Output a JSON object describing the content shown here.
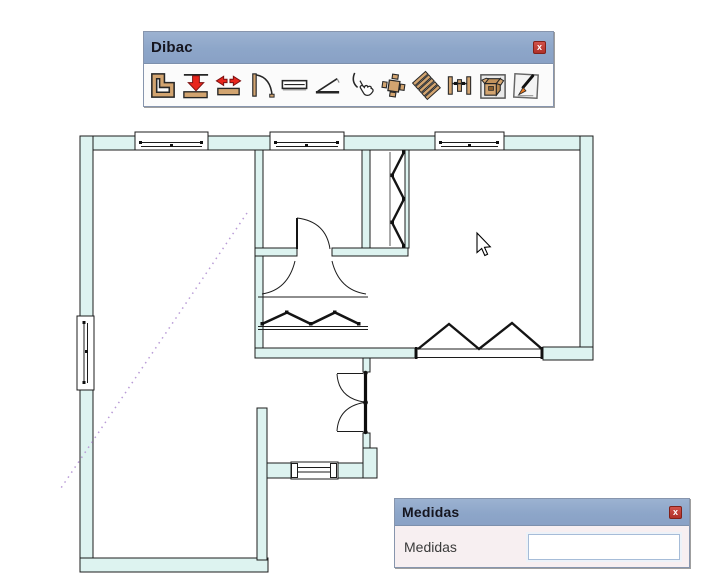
{
  "canvas": {
    "background": "#ffffff"
  },
  "dibac_toolbar": {
    "title": "Dibac",
    "close_label": "x",
    "icons": [
      {
        "name": "wall-polygon-icon"
      },
      {
        "name": "extrude-walls-icon"
      },
      {
        "name": "wall-width-icon"
      },
      {
        "name": "door-icon"
      },
      {
        "name": "window-icon"
      },
      {
        "name": "tilt-window-icon"
      },
      {
        "name": "pick-curve-icon"
      },
      {
        "name": "furniture-table-icon"
      },
      {
        "name": "stairs-icon"
      },
      {
        "name": "carpentry-posts-icon"
      },
      {
        "name": "furniture-box-icon"
      },
      {
        "name": "edit-pen-icon"
      }
    ]
  },
  "medidas_dialog": {
    "title": "Medidas",
    "close_label": "x",
    "field_label": "Medidas",
    "field_value": "",
    "field_placeholder": ""
  },
  "colors": {
    "wall_fill": "#ddf3f0",
    "titlebar": "#8da6c9",
    "title_text": "#15151f",
    "close_button": "#bf3b33",
    "dialog_body": "#f7eff1",
    "dotted_line": "#b99bd6",
    "plan_outline": "#1c1c1c"
  }
}
